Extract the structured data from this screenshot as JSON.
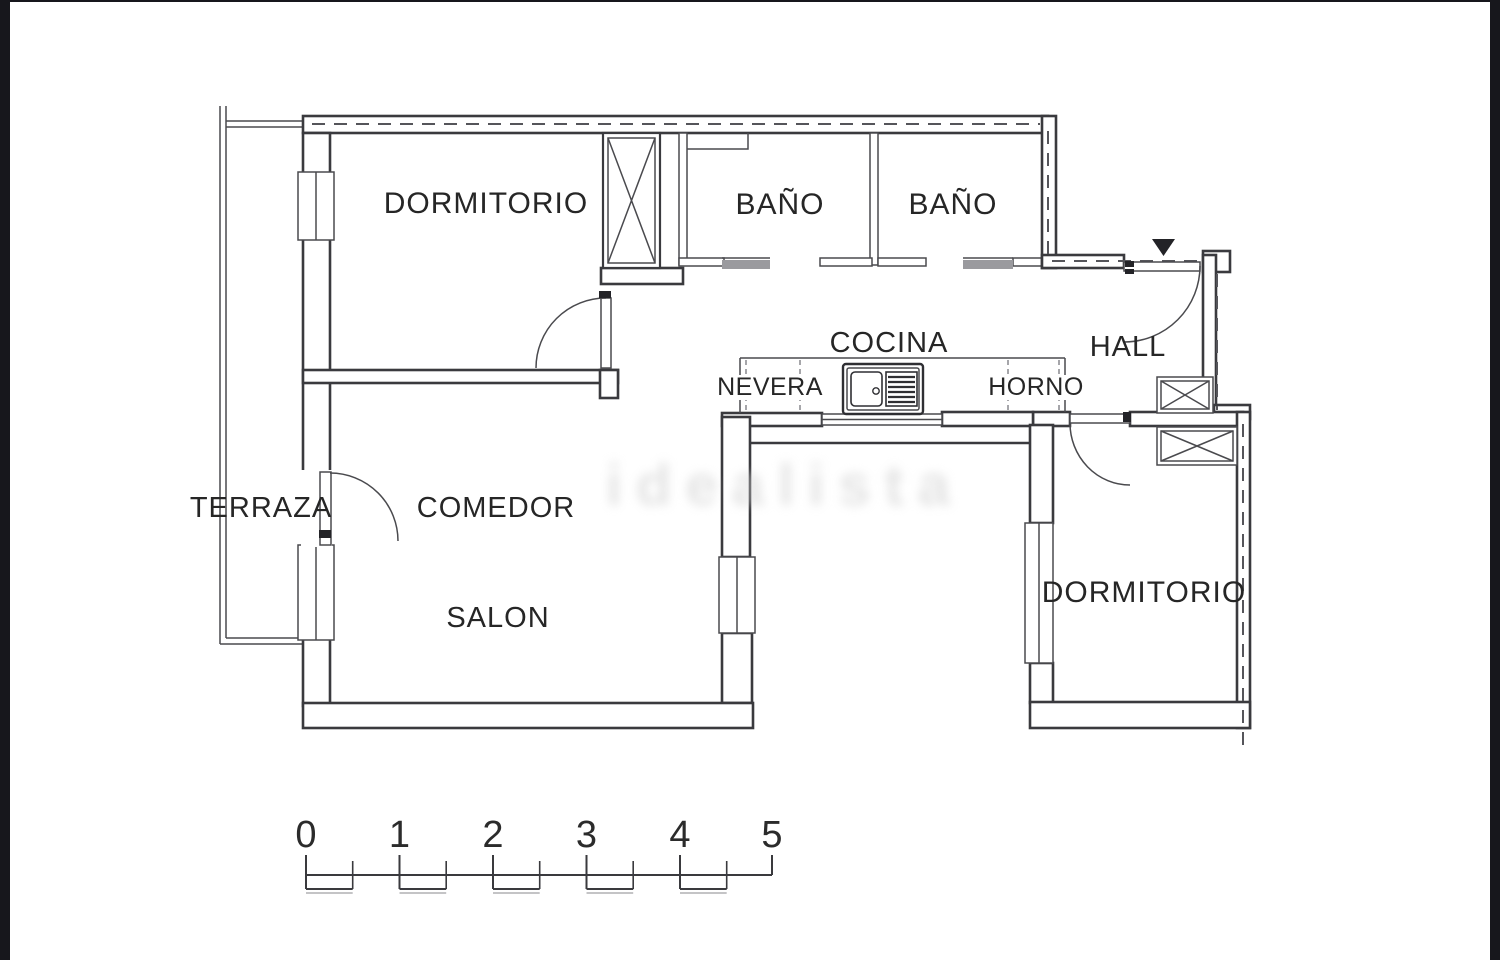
{
  "image": {
    "kind": "apartment-floor-plan",
    "colors": {
      "background": "#ffffff",
      "edge_bars": "#17171c",
      "wall_line": "#3a3a3e",
      "dashed_boundary": "#55555a",
      "sliding_door_fill": "#9a9a9e",
      "label_text": "#262626",
      "watermark": "#d2d2d2"
    }
  },
  "rooms": {
    "dormitorio_top": {
      "label": "DORMITORIO"
    },
    "bano_left": {
      "label": "BAÑO"
    },
    "bano_right": {
      "label": "BAÑO"
    },
    "cocina": {
      "label": "COCINA"
    },
    "nevera": {
      "label": "NEVERA"
    },
    "horno": {
      "label": "HORNO"
    },
    "hall": {
      "label": "HALL"
    },
    "terraza": {
      "label": "TERRAZA"
    },
    "comedor": {
      "label": "COMEDOR"
    },
    "salon": {
      "label": "SALON"
    },
    "dormitorio_bottom": {
      "label": "DORMITORIO"
    }
  },
  "watermark": {
    "text": "idealista"
  },
  "scale_bar": {
    "units": [
      "0",
      "1",
      "2",
      "3",
      "4",
      "5"
    ]
  }
}
